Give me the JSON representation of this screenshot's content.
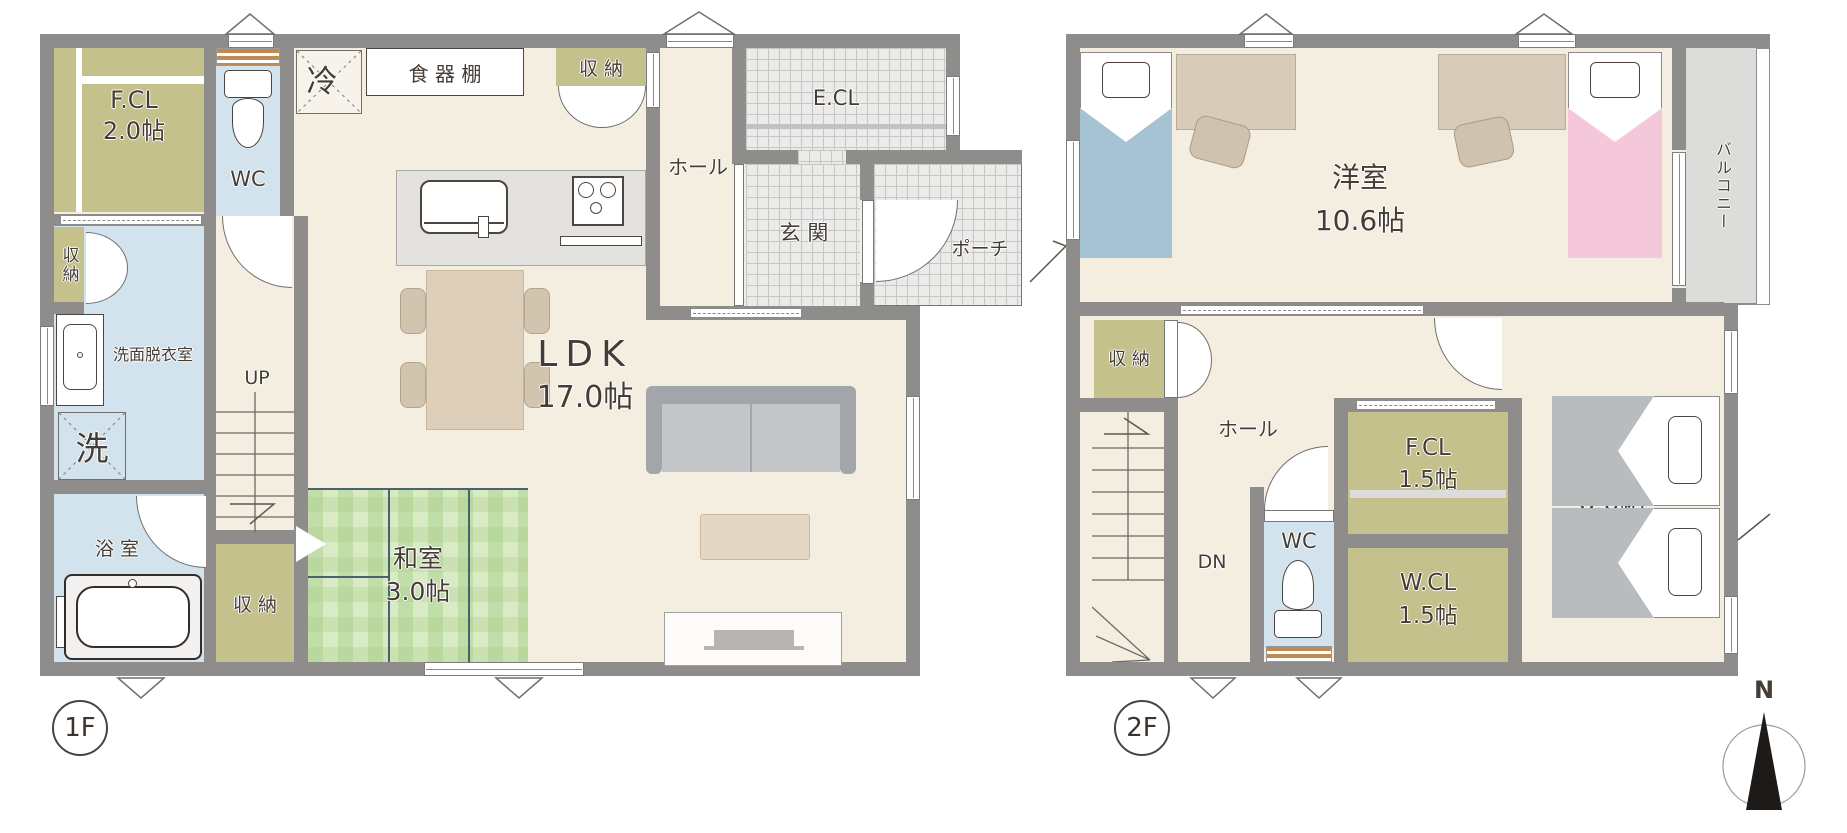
{
  "colors": {
    "wall": "#8e8d8b",
    "floor_cream": "#f4eee1",
    "closet_olive": "#c5c18c",
    "wet_area_blue": "#d2e3ed",
    "tatami_green": "#d9ebc5",
    "tile_gray": "#ebebe9",
    "balcony_gray": "#dcdcda",
    "bed_blue": "#a6c3d3",
    "bed_pink": "#f4c8da",
    "bed_gray": "#b9bcbe",
    "shelf_brown": "#bc8a52"
  },
  "floor1": {
    "badge": "1F",
    "rooms": {
      "fcl": {
        "name": "F.CL",
        "size": "2.0帖"
      },
      "wc": "WC",
      "refrigerator": "冷",
      "cupboard": "食 器 棚",
      "storage_top": "収 納",
      "hall": "ホール",
      "ecl": "E.CL",
      "genkan": "玄 関",
      "porch": "ポーチ",
      "storage_left": "収納",
      "senmen": "洗面脱衣室",
      "washer": "洗",
      "stairs": "UP",
      "bath": "浴 室",
      "storage_bottom": "収 納",
      "washitsu": {
        "name": "和室",
        "size": "3.0帖"
      },
      "ldk": {
        "name": "LDK",
        "size": "17.0帖"
      }
    }
  },
  "floor2": {
    "badge": "2F",
    "rooms": {
      "yoshitsu": {
        "name": "洋室",
        "size": "10.6帖"
      },
      "balcony": "バルコニー",
      "storage": "収 納",
      "hall": "ホール",
      "stairs": "DN",
      "wc": "WC",
      "fcl": {
        "name": "F.CL",
        "size": "1.5帖"
      },
      "wcl": {
        "name": "W.CL",
        "size": "1.5帖"
      },
      "bedroom": {
        "name": "寝室",
        "size": "6.0帖"
      }
    }
  },
  "compass": {
    "north": "N"
  }
}
